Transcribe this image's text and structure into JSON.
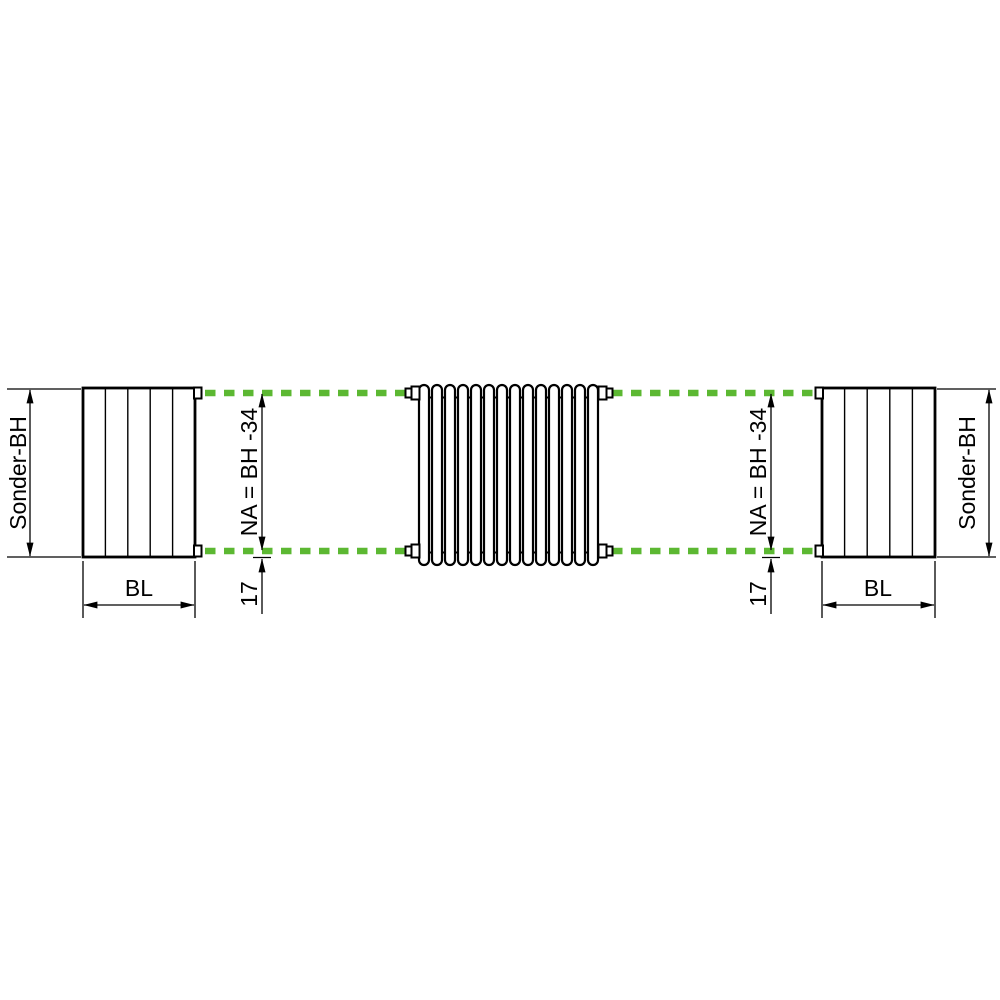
{
  "diagram": {
    "type": "radiator-dimension-drawing",
    "left_block": {
      "height_label": "Sonder-BH",
      "width_label": "BL"
    },
    "right_block": {
      "height_label": "Sonder-BH",
      "width_label": "BL"
    },
    "center": {
      "tube_count": 14,
      "left_axis_label": "NA = BH -34",
      "left_offset_label": "17",
      "right_axis_label": "NA = BH -34",
      "right_offset_label": "17"
    },
    "colors": {
      "dash_green": "#5cb832",
      "line_black": "#000000",
      "background": "#ffffff"
    }
  }
}
